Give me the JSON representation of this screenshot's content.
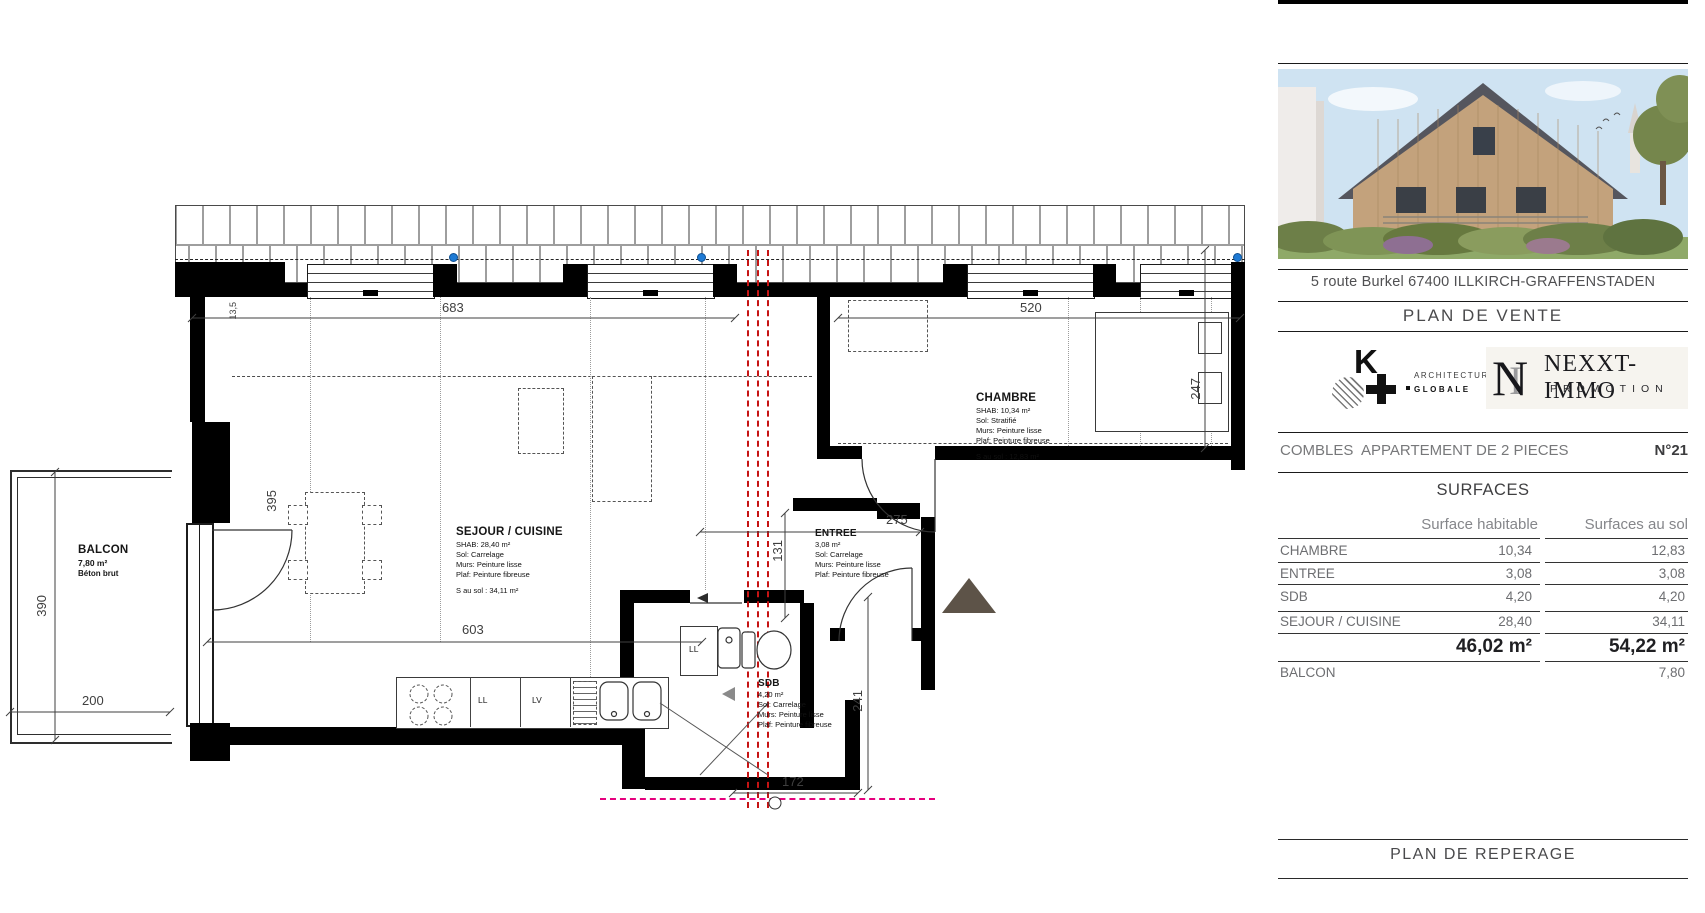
{
  "plan": {
    "balcon": {
      "name": "BALCON",
      "area": "7,80 m²",
      "floor": "Béton brut"
    },
    "sejour": {
      "name": "SEJOUR / CUISINE",
      "shab": "SHAB: 28,40 m²",
      "sol": "Sol: Carrelage",
      "murs": "Murs: Peinture lisse",
      "plaf": "Plaf: Peinture fibreuse",
      "ssol": "S au sol : 34,11 m²"
    },
    "chambre": {
      "name": "CHAMBRE",
      "shab": "SHAB: 10,34 m²",
      "sol": "Sol: Stratifié",
      "murs": "Murs: Peinture lisse",
      "plaf": "Plaf: Peinture fibreuse",
      "ssol": "S au sol : 12,83 m²"
    },
    "entree": {
      "name": "ENTREE",
      "shab": "3,08 m²",
      "sol": "Sol: Carrelage",
      "murs": "Murs: Peinture lisse",
      "plaf": "Plaf: Peinture fibreuse"
    },
    "sdb": {
      "name": "SDB",
      "shab": "4,20 m²",
      "sol": "Sol: Carrelage",
      "murs": "Murs: Peinture lisse",
      "plaf": "Plaf: Peinture fibreuse"
    },
    "appliances": {
      "ll": "LL",
      "lv": "LV",
      "ll2": "LL"
    },
    "dims": {
      "d683": "683",
      "d520": "520",
      "d603": "603",
      "d275": "275",
      "d131": "131",
      "d247": "247",
      "d395": "395",
      "d135": "13,5",
      "d390": "390",
      "d200": "200",
      "d241": "241",
      "d172": "172"
    }
  },
  "sidebar": {
    "address": "5 route Burkel 67400 ILLKIRCH-GRAFFENSTADEN",
    "plan_title": "PLAN DE VENTE",
    "footer_title": "PLAN DE REPERAGE",
    "architect_logo": {
      "letter": "K",
      "line1": "ARCHITECTURE",
      "line2": "GLOBALE"
    },
    "promoter_logo": {
      "monogram_n": "N",
      "monogram_i": "I",
      "name": "NEXXT-IMMO",
      "subtitle": "PROMOTION"
    },
    "apartment": {
      "level": "COMBLES",
      "type": "APPARTEMENT DE 2 PIECES",
      "number": "N°21"
    },
    "surfaces": {
      "title": "SURFACES",
      "col_hab": "Surface habitable",
      "col_sol": "Surfaces au sol",
      "rows": [
        {
          "label": "CHAMBRE",
          "hab": "10,34",
          "sol": "12,83"
        },
        {
          "label": "ENTREE",
          "hab": "3,08",
          "sol": "3,08"
        },
        {
          "label": "SDB",
          "hab": "4,20",
          "sol": "4,20"
        },
        {
          "label": "SEJOUR / CUISINE",
          "hab": "28,40",
          "sol": "34,11"
        }
      ],
      "total_hab": "46,02 m²",
      "total_sol": "54,22 m²",
      "balcon_label": "BALCON",
      "balcon_sol": "7,80"
    }
  }
}
